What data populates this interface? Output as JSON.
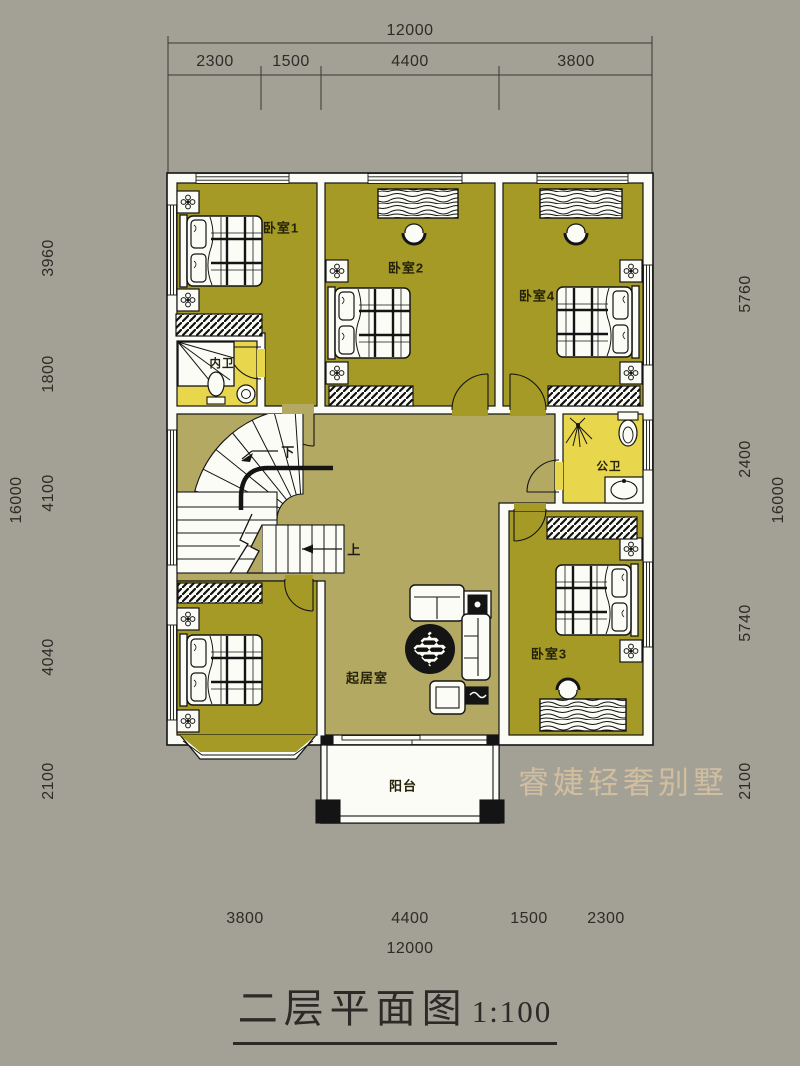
{
  "plan": {
    "title": "二层平面图",
    "scale": "1:100",
    "watermark": "睿婕轻奢别墅",
    "rooms": {
      "bedroom1": "卧室1",
      "bedroom2": "卧室2",
      "bedroom3": "卧室3",
      "bedroom4": "卧室4",
      "ensuite_bath": "内卫",
      "public_bath": "公卫",
      "living_room": "起居室",
      "balcony": "阳台"
    },
    "stairs": {
      "down": "下",
      "up": "上"
    },
    "colors": {
      "background": "#a3a096",
      "bedroom_floor": "#a49a25",
      "hall_floor": "#b3a963",
      "bath_floor": "#e8d64d",
      "wall": "#fcfcf7",
      "line": "#141414"
    }
  },
  "dimensions": {
    "top": {
      "total": "12000",
      "segments": [
        "2300",
        "1500",
        "4400",
        "3800"
      ]
    },
    "bottom": {
      "total": "12000",
      "segments": [
        "3800",
        "4400",
        "1500",
        "2300"
      ]
    },
    "left": {
      "total": "16000",
      "segments": [
        "3960",
        "1800",
        "4100",
        "4040",
        "2100"
      ]
    },
    "right": {
      "total": "16000",
      "segments": [
        "5760",
        "2400",
        "5740",
        "2100"
      ]
    }
  }
}
